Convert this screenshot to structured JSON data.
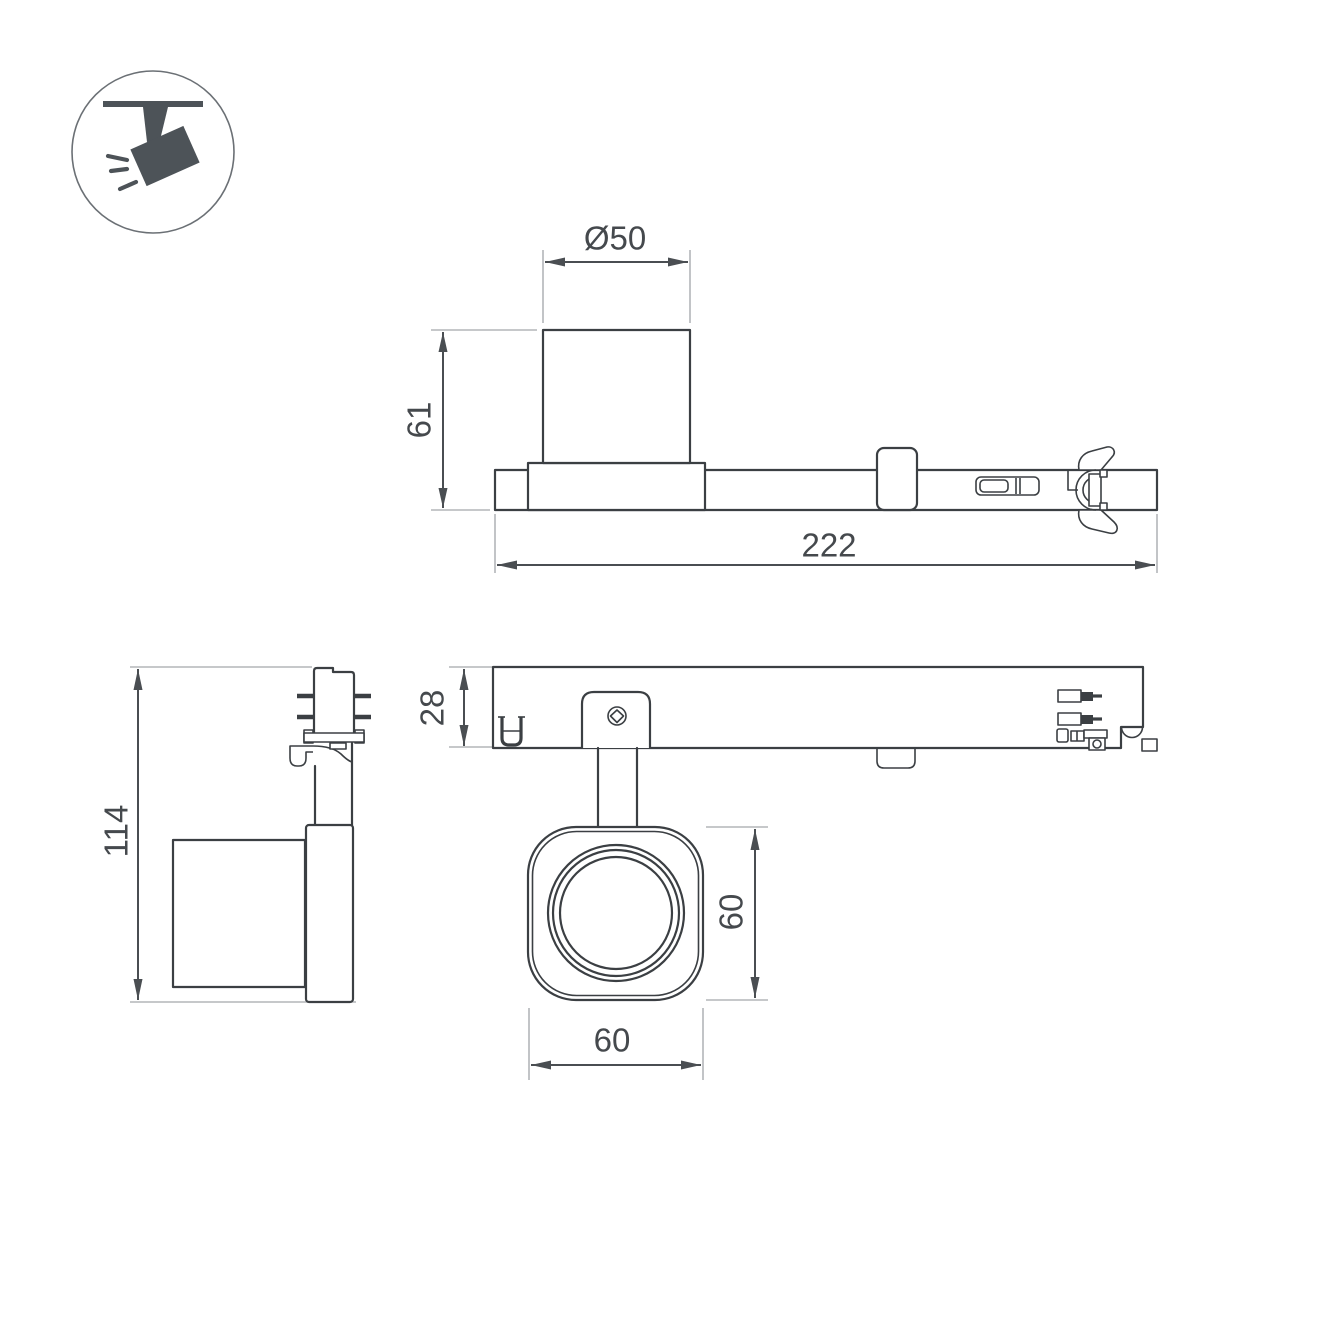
{
  "icon_badge": {
    "symbol": "ceiling-track-spotlight"
  },
  "dimensions": {
    "side_view": {
      "lens_diameter": "Ø50",
      "body_height": "61",
      "total_length": "222"
    },
    "front_view": {
      "total_height": "114"
    },
    "top_view": {
      "track_depth": "28"
    },
    "bottom_view": {
      "head_height": "60",
      "head_width": "60"
    }
  },
  "colors": {
    "object_line": "#3b3f43",
    "dimension_line": "#4a4e52",
    "extension_line": "#b3b6b9",
    "icon_fill": "#4d5358",
    "background": "#ffffff"
  }
}
